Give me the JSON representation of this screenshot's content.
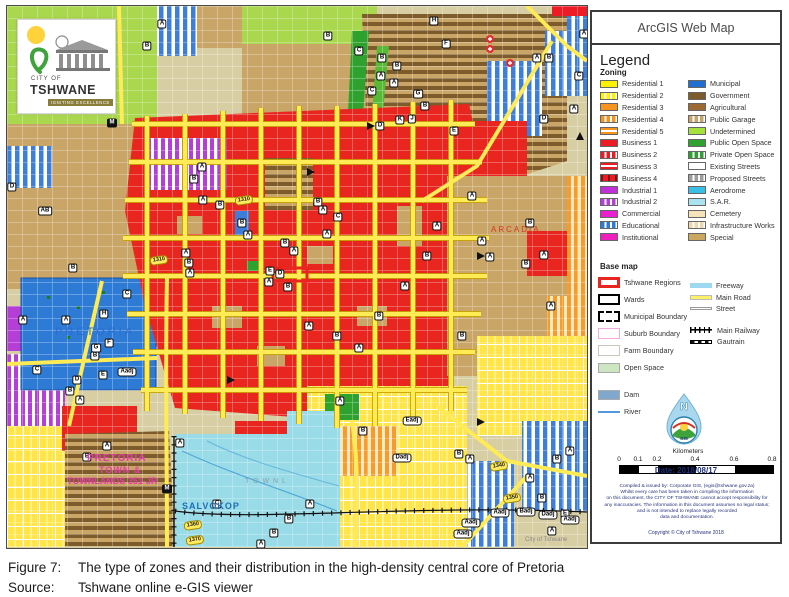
{
  "window": {
    "map_title": "ArcGIS Web Map"
  },
  "caption": {
    "figure_label": "Figure 7:",
    "figure_text": "The type of zones and their distribution in the high-density central core of Pretoria",
    "source_label": "Source:",
    "source_text": "Tshwane online e-GIS viewer"
  },
  "legend": {
    "title": "Legend",
    "zoning_heading": "Zoning",
    "zoning_columns": [
      [
        {
          "label": "Residential 1",
          "color": "#FFF200",
          "pattern": "solid"
        },
        {
          "label": "Residential 2",
          "color": "#FFF200",
          "pattern": "vstripe"
        },
        {
          "label": "Residential 3",
          "color": "#F7941E",
          "pattern": "solid"
        },
        {
          "label": "Residential 4",
          "color": "#F7941E",
          "pattern": "vstripe"
        },
        {
          "label": "Residential 5",
          "color": "#F7941E",
          "pattern": "hstripe"
        },
        {
          "label": "Business 1",
          "color": "#ED1C24",
          "pattern": "solid"
        },
        {
          "label": "Business 2",
          "color": "#ED1C24",
          "pattern": "vstripe"
        },
        {
          "label": "Business 3",
          "color": "#ED1C24",
          "pattern": "hstripe"
        },
        {
          "label": "Business 4",
          "color": "#ED1C24",
          "pattern": "marks"
        },
        {
          "label": "Industrial 1",
          "color": "#C02FD8",
          "pattern": "solid"
        },
        {
          "label": "Industrial 2",
          "color": "#B53ED6",
          "pattern": "vstripe"
        },
        {
          "label": "Commercial",
          "color": "#EA1FD0",
          "pattern": "solid"
        },
        {
          "label": "Educational",
          "color": "#2E7BD6",
          "pattern": "vstripe"
        },
        {
          "label": "Institutional",
          "color": "#EE1FBE",
          "pattern": "solid"
        }
      ],
      [
        {
          "label": "Municipal",
          "color": "#1F6FD0",
          "pattern": "solid"
        },
        {
          "label": "Government",
          "color": "#7E5B2A",
          "pattern": "solid"
        },
        {
          "label": "Agricultural",
          "color": "#9C6B33",
          "pattern": "solid"
        },
        {
          "label": "Public Garage",
          "color": "#C9A668",
          "pattern": "vstripe"
        },
        {
          "label": "Undetermined",
          "color": "#A5E13C",
          "pattern": "solid"
        },
        {
          "label": "Public Open Space",
          "color": "#2FA12F",
          "pattern": "solid"
        },
        {
          "label": "Private Open Space",
          "color": "#2FA12F",
          "pattern": "vstripe"
        },
        {
          "label": "Existing Streets",
          "color": "#FFFFFF",
          "pattern": "solid"
        },
        {
          "label": "Proposed Streets",
          "color": "#9E9E9E",
          "pattern": "vstripe"
        },
        {
          "label": "Aerodrome",
          "color": "#39BEE8",
          "pattern": "solid"
        },
        {
          "label": "S.A.R.",
          "color": "#A8E3EF",
          "pattern": "solid"
        },
        {
          "label": "Cemetery",
          "color": "#F5E3BC",
          "pattern": "solid"
        },
        {
          "label": "Infrastructure Works",
          "color": "#EBD8AC",
          "pattern": "vstripe"
        },
        {
          "label": "Special",
          "color": "#CBA85F",
          "pattern": "solid"
        }
      ]
    ],
    "basemap_heading": "Base map",
    "basemap_left": [
      {
        "label": "Tshwane Regions",
        "type": "outline",
        "color": "#E8251F",
        "thick": 3
      },
      {
        "label": "Wards",
        "type": "outline",
        "color": "#000000",
        "thick": 2
      },
      {
        "label": "Municipal Boundary",
        "type": "dashed",
        "color": "#000000"
      },
      {
        "label": "Suburb Boundary",
        "type": "outline",
        "color": "#F5A9DD",
        "thick": 1
      },
      {
        "label": "Farm Boundary",
        "type": "outline",
        "color": "#CCC6BA",
        "thick": 1
      },
      {
        "label": "Open Space",
        "type": "fill",
        "color": "#CDE6C2"
      },
      {
        "label": "Dam",
        "type": "fill",
        "color": "#7FA8CC",
        "gap": true
      },
      {
        "label": "River",
        "type": "line",
        "color": "#5599DD",
        "h": 1.5
      }
    ],
    "basemap_right": [
      {
        "label": "Freeway",
        "type": "line",
        "color": "#9DD7F0",
        "h": 5
      },
      {
        "label": "Main Road",
        "type": "line",
        "color": "#FFF066",
        "h": 5,
        "border": "#bbbbbb"
      },
      {
        "label": "Street",
        "type": "line",
        "color": "#FFFFFF",
        "h": 3,
        "border": "#999999"
      },
      {
        "label": "Main Railway",
        "type": "railway",
        "gap": true
      },
      {
        "label": "Gautrain",
        "type": "gautrain"
      }
    ],
    "scalebar": {
      "units_label": "Kilometers",
      "ticks": [
        {
          "t": "0",
          "p": 17
        },
        {
          "t": "0.1",
          "p": 36
        },
        {
          "t": "0.2",
          "p": 55
        },
        {
          "t": "0.4",
          "p": 93
        },
        {
          "t": "0.6",
          "p": 132
        },
        {
          "t": "0.8",
          "p": 170
        }
      ],
      "segments": [
        {
          "w": 19,
          "c": "#000"
        },
        {
          "w": 19,
          "c": "#fff"
        },
        {
          "w": 38,
          "c": "#000"
        },
        {
          "w": 39,
          "c": "#fff"
        },
        {
          "w": 38,
          "c": "#000"
        }
      ]
    },
    "date_label": "Date: 2018/08/17",
    "disclaimer_lines": [
      "Compiled & issued by: Corporate GIS, (egis@tshwane.gov.za)",
      "Whilst every care has been taken in compiling the information",
      "on this document, the CITY OF TSHWANE cannot accept responsibility for",
      "any inaccuracies. The information in this document assumes no legal status;",
      "and is not intended to replace legally recorded",
      "data and documentation."
    ],
    "copyright": "Copyright © City of Tshwane 2018",
    "north_logo": {
      "letter": "N",
      "sub": "GIS"
    }
  },
  "map": {
    "logo": {
      "line1": "CITY OF",
      "line2": "TSHWANE",
      "line3": "IGNITING EXCELLENCE"
    },
    "watermark": "City of Tshwane",
    "place_labels": [
      {
        "t": "PRETORIA",
        "x": 48,
        "y": 320,
        "c": "#2b6bd4",
        "fs": 11,
        "ls": 3,
        "b": 0
      },
      {
        "t": "ARCADIA",
        "x": 484,
        "y": 219,
        "c": "#d23a28",
        "fs": 8,
        "ls": 2,
        "b": 0
      },
      {
        "t": "SALVOKOP",
        "x": 175,
        "y": 495,
        "c": "#1d6fb8",
        "fs": 9,
        "ls": 1,
        "b": 1
      },
      {
        "t": "PRETORIA",
        "x": 80,
        "y": 447,
        "c": "#e73bae",
        "fs": 10,
        "ls": 1,
        "b": 1
      },
      {
        "t": "TOWN &",
        "x": 92,
        "y": 459,
        "c": "#e73bae",
        "fs": 9,
        "ls": 1,
        "b": 1
      },
      {
        "t": "TOWNLANDS 351-JR",
        "x": 60,
        "y": 470,
        "c": "#e73bae",
        "fs": 9,
        "ls": 0,
        "b": 1
      },
      {
        "t": "T O W N L",
        "x": 238,
        "y": 472,
        "c": "#8aa0a8",
        "fs": 7,
        "ls": 1,
        "b": 0
      }
    ],
    "road_labels": [
      {
        "t": "1310",
        "x": 237,
        "y": 194
      },
      {
        "t": "1310",
        "x": 152,
        "y": 254
      },
      {
        "t": "1340",
        "x": 492,
        "y": 460
      },
      {
        "t": "1350",
        "x": 505,
        "y": 492
      },
      {
        "t": "1360",
        "x": 186,
        "y": 519
      },
      {
        "t": "1370",
        "x": 188,
        "y": 534
      }
    ],
    "badges": [
      [
        "H",
        427,
        15
      ],
      [
        "F",
        439,
        38
      ],
      [
        "B",
        375,
        52
      ],
      [
        "B",
        390,
        60
      ],
      [
        "A",
        374,
        70
      ],
      [
        "A",
        387,
        77
      ],
      [
        "C",
        365,
        85
      ],
      [
        "G",
        411,
        88
      ],
      [
        "B",
        418,
        100
      ],
      [
        "J",
        405,
        113
      ],
      [
        "K",
        393,
        114
      ],
      [
        "D",
        373,
        120
      ],
      [
        "E",
        447,
        125
      ],
      [
        "D",
        537,
        113
      ],
      [
        "A",
        567,
        103
      ],
      [
        "C",
        572,
        70
      ],
      [
        "A",
        530,
        52
      ],
      [
        "B",
        542,
        52
      ],
      [
        "A",
        577,
        28
      ],
      [
        "B",
        321,
        30
      ],
      [
        "C",
        352,
        45
      ],
      [
        "A",
        155,
        18
      ],
      [
        "B",
        140,
        40
      ],
      [
        "AB",
        38,
        205
      ],
      [
        "A",
        16,
        314
      ],
      [
        "A",
        59,
        314
      ],
      [
        "C",
        30,
        364
      ],
      [
        "H",
        97,
        308
      ],
      [
        "G",
        89,
        342
      ],
      [
        "F",
        102,
        337
      ],
      [
        "B",
        88,
        350
      ],
      [
        "E",
        96,
        369
      ],
      [
        "D",
        70,
        374
      ],
      [
        "B",
        63,
        385
      ],
      [
        "A",
        73,
        394
      ],
      [
        "C",
        120,
        288
      ],
      [
        "D",
        5,
        181
      ],
      [
        "B",
        66,
        262
      ],
      [
        "A",
        195,
        161
      ],
      [
        "B",
        187,
        173
      ],
      [
        "A",
        196,
        194
      ],
      [
        "B",
        213,
        199
      ],
      [
        "B",
        235,
        217
      ],
      [
        "A",
        241,
        229
      ],
      [
        "A",
        179,
        247
      ],
      [
        "B",
        182,
        257
      ],
      [
        "A",
        183,
        267
      ],
      [
        "B",
        311,
        196
      ],
      [
        "A",
        316,
        204
      ],
      [
        "C",
        331,
        211
      ],
      [
        "A",
        320,
        228
      ],
      [
        "B",
        278,
        237
      ],
      [
        "A",
        287,
        245
      ],
      [
        "E",
        263,
        265
      ],
      [
        "D",
        273,
        268
      ],
      [
        "A",
        262,
        276
      ],
      [
        "B",
        281,
        281
      ],
      [
        "A",
        302,
        320
      ],
      [
        "B",
        330,
        330
      ],
      [
        "A",
        352,
        342
      ],
      [
        "B",
        372,
        310
      ],
      [
        "A",
        398,
        280
      ],
      [
        "B",
        420,
        250
      ],
      [
        "A",
        430,
        220
      ],
      [
        "B",
        455,
        330
      ],
      [
        "A",
        465,
        190
      ],
      [
        "B",
        523,
        217
      ],
      [
        "A",
        475,
        235
      ],
      [
        "A",
        483,
        251
      ],
      [
        "B",
        519,
        258
      ],
      [
        "A",
        537,
        249
      ],
      [
        "A",
        544,
        300
      ],
      [
        "A",
        333,
        395
      ],
      [
        "B",
        356,
        425
      ],
      [
        "A",
        100,
        440
      ],
      [
        "B",
        80,
        451
      ],
      [
        "A",
        173,
        437
      ],
      [
        "C",
        210,
        498
      ],
      [
        "A",
        303,
        498
      ],
      [
        "B",
        282,
        513
      ],
      [
        "B",
        267,
        527
      ],
      [
        "A",
        254,
        538
      ],
      [
        "B",
        452,
        448
      ],
      [
        "A",
        463,
        453
      ],
      [
        "B",
        550,
        453
      ],
      [
        "A",
        563,
        445
      ],
      [
        "A",
        523,
        472
      ],
      [
        "B",
        535,
        492
      ],
      [
        "E",
        558,
        508
      ],
      [
        "A",
        545,
        525
      ]
    ],
    "adj_badges": [
      [
        "Aadj",
        120,
        366
      ],
      [
        "Eadj",
        405,
        415
      ],
      [
        "Dadj",
        395,
        452
      ],
      [
        "Aadj",
        493,
        507
      ],
      [
        "Badj",
        519,
        506
      ],
      [
        "Dadj",
        541,
        509
      ],
      [
        "Aadj",
        563,
        514
      ],
      [
        "Aadj",
        464,
        517
      ],
      [
        "Aadj",
        456,
        528
      ]
    ],
    "metro_badges": [
      [
        "M",
        105,
        117
      ],
      [
        "M",
        160,
        483
      ]
    ]
  },
  "colors": {
    "business1": "#ED1C24",
    "municipal": "#1F6FD0",
    "government": "#7E5B2A",
    "special": "#CBA85F",
    "sar": "#A8E3EF",
    "public_open": "#2FA12F",
    "undetermined": "#A5E13C",
    "main_road": "#FFE95C"
  }
}
